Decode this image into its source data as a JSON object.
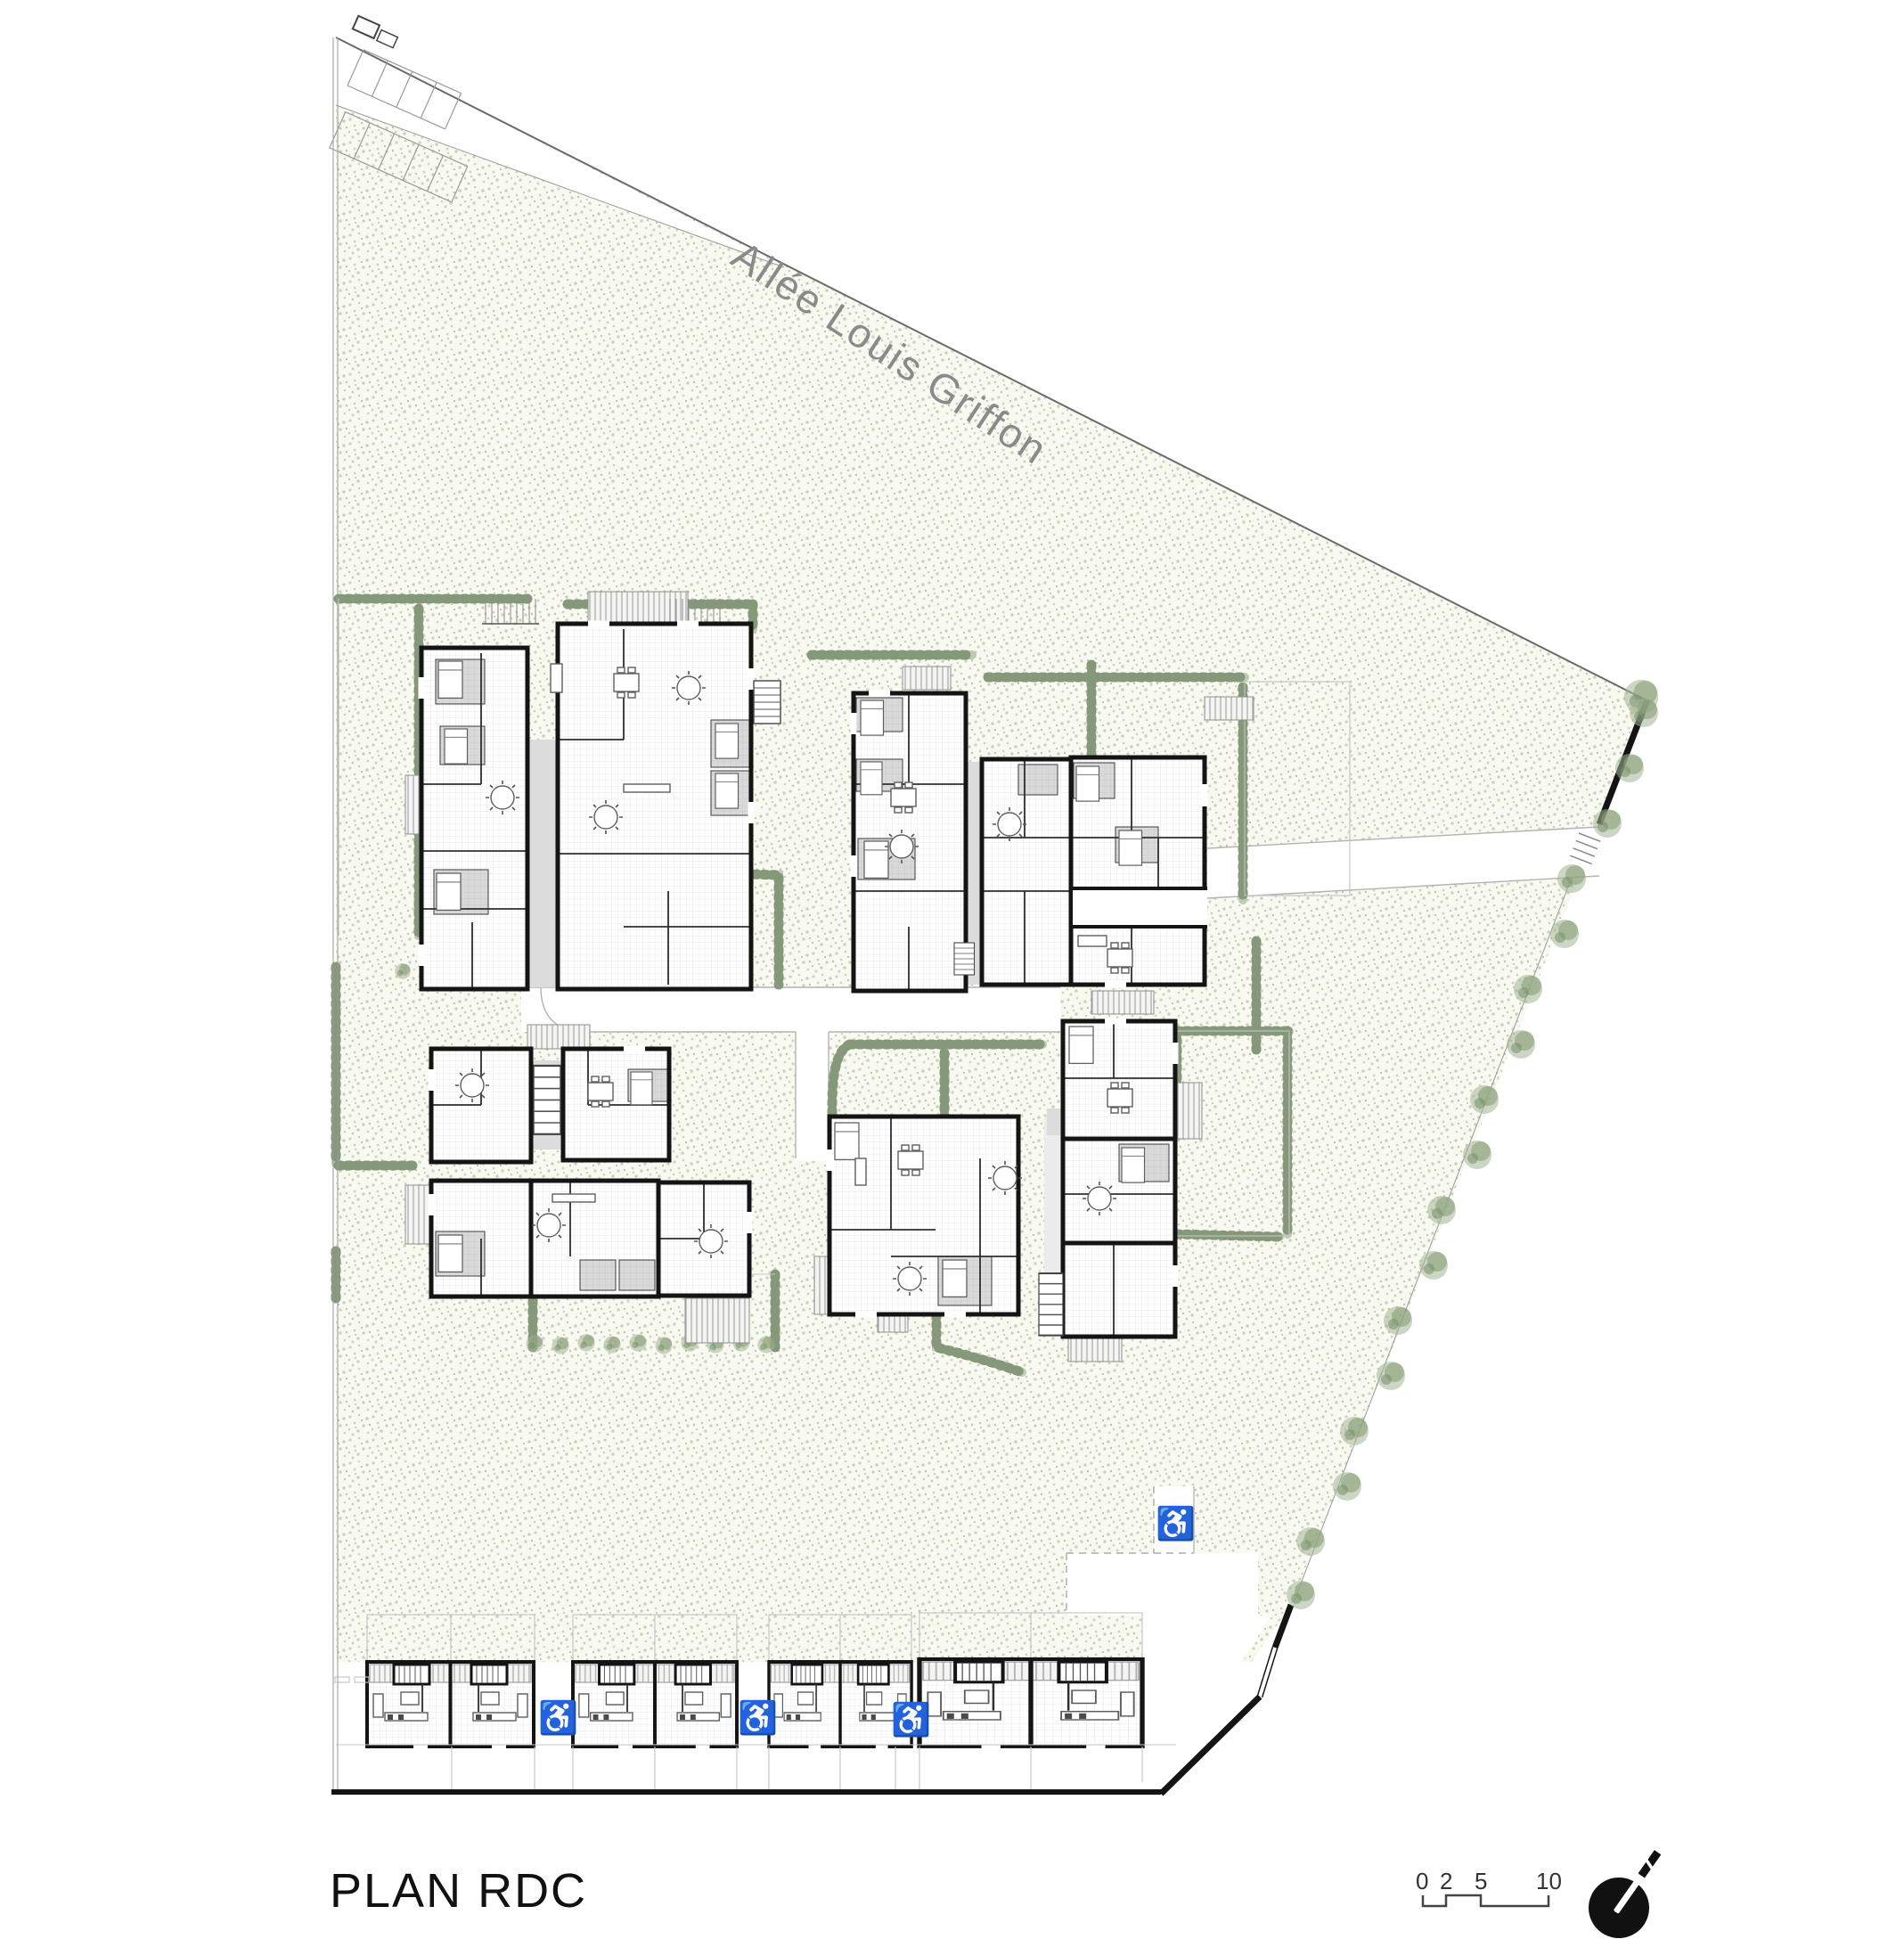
{
  "sheet": {
    "title": "PLAN RDC",
    "drawing_type": "ground-floor-site-plan"
  },
  "street": {
    "name": "Allée Louis Griffon"
  },
  "scale_bar": {
    "ticks": [
      "0",
      "2",
      "5",
      "10"
    ]
  },
  "icons": {
    "accessible_parking": "♿",
    "north_arrow": "north-arrow"
  },
  "colors": {
    "paper": "#ffffff",
    "lawn_base": "#f8f9f1",
    "lawn_dot": "#d0d1bc",
    "hedge_green": "#85987a",
    "tree_green": "#a3b494",
    "wall_black": "#141414",
    "room_gray": "#d9d9d9",
    "hatch_gray": "#aeaeae",
    "grid_gray": "#e4e4e4",
    "boundary_gray": "#6b6b6b",
    "street_label_gray": "#8a8a8a",
    "title_black": "#111111",
    "accessible_gray": "#ababab"
  }
}
